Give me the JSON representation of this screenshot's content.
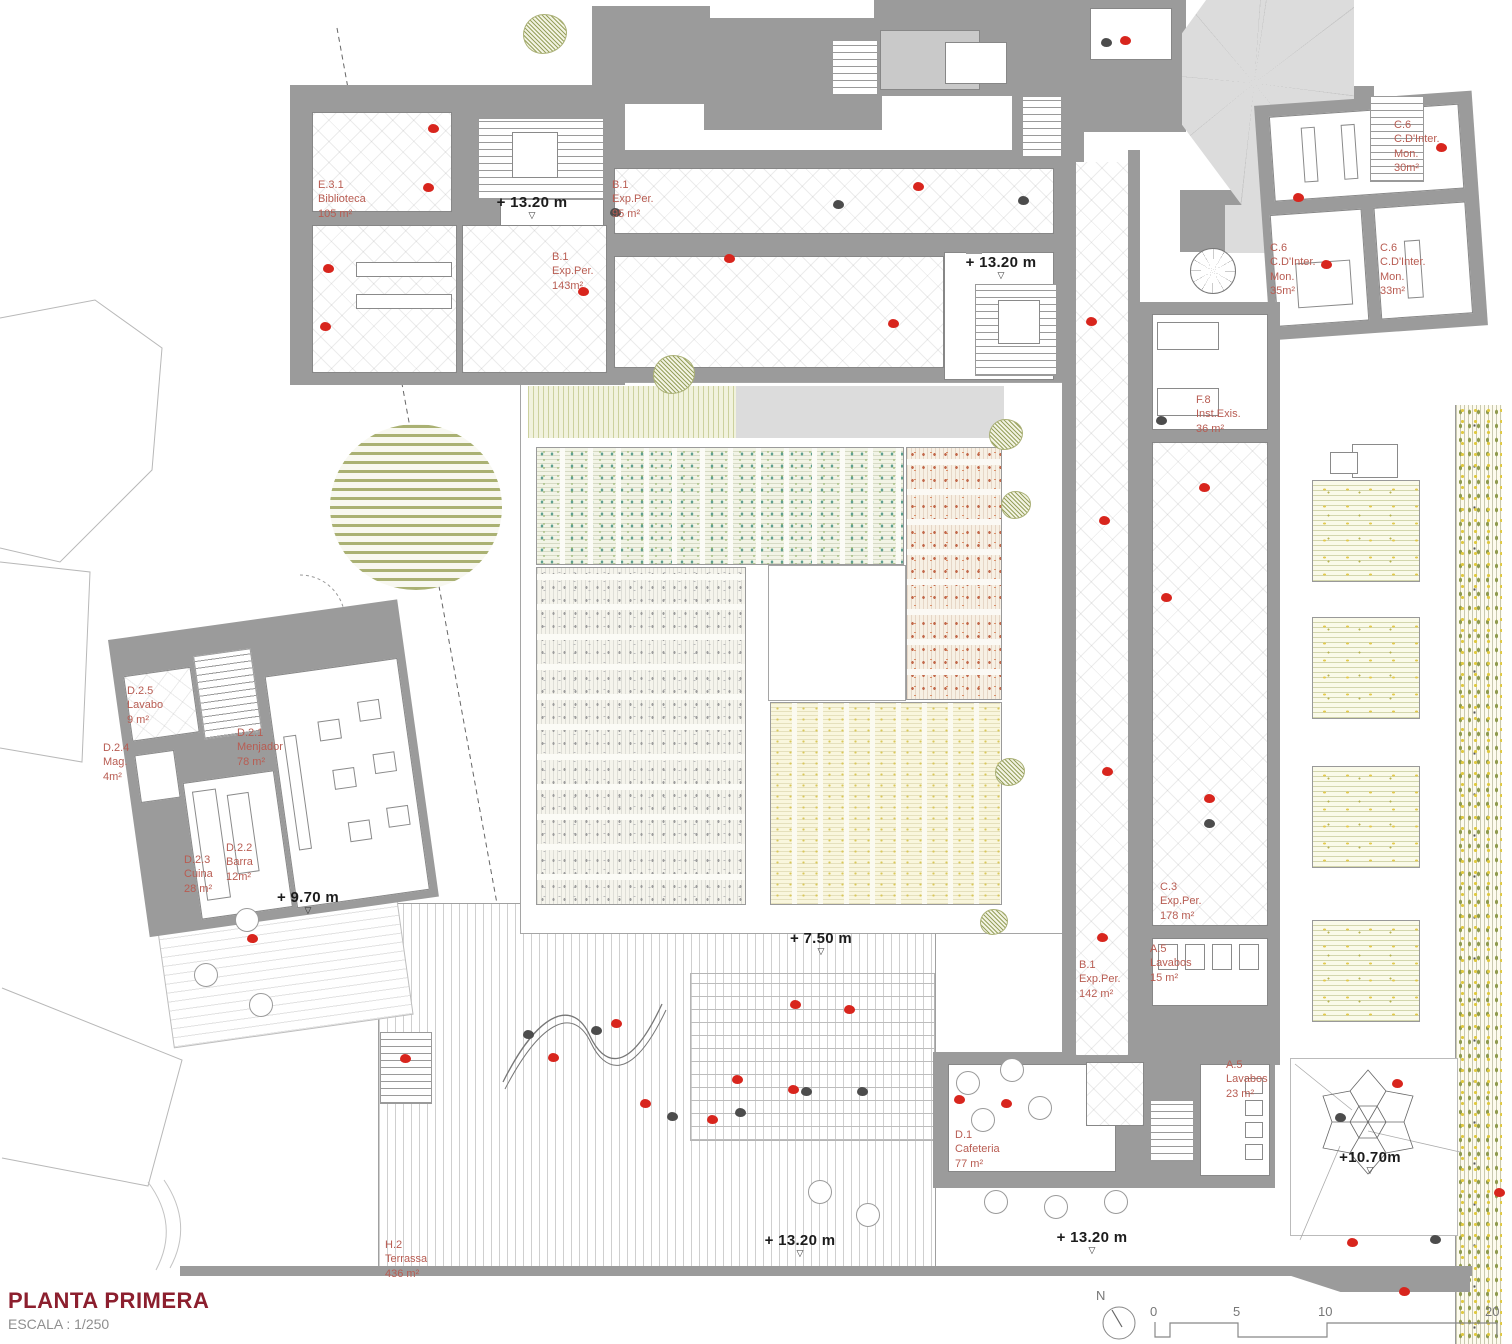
{
  "title": {
    "main": "PLANTA PRIMERA",
    "scale": "ESCALA : 1/250"
  },
  "colors": {
    "accent_red": "#d8251d",
    "label_red": "#b85c52",
    "wall_gray": "#9b9b9b",
    "title_red": "#8c1f2e"
  },
  "rooms": [
    {
      "label": "E.3.1\nBiblioteca\n105 m²"
    },
    {
      "label": "B.1\nExp.Per.\n95 m²"
    },
    {
      "label": "B.1\nExp.Per.\n143m²"
    },
    {
      "label": "C.6\nC.D'Inter.\nMon.\n30m²"
    },
    {
      "label": "C.6\nC.D'Inter.\nMon.\n35m²"
    },
    {
      "label": "C.6\nC.D'Inter.\nMon.\n33m²"
    },
    {
      "label": "F.8\nInst.Exis.\n36 m²"
    },
    {
      "label": "D.2.5\nLavabo\n9 m²"
    },
    {
      "label": "D.2.4\nMag.\n4m²"
    },
    {
      "label": "D.2.1\nMenjador\n78 m²"
    },
    {
      "label": "D.2.3\nCuina\n28 m²"
    },
    {
      "label": "D.2.2\nBarra\n12m²"
    },
    {
      "label": "C.3\nExp.Per.\n178 m²"
    },
    {
      "label": "A.5\nLavabos\n15 m²"
    },
    {
      "label": "B.1\nExp.Per.\n142 m²"
    },
    {
      "label": "A.5\nLavabos\n23 m²"
    },
    {
      "label": "D.1\nCafeteria\n77 m²"
    },
    {
      "label": "H.2\nTerrassa\n436 m²"
    }
  ],
  "levels": [
    {
      "text": "+ 13.20 m"
    },
    {
      "text": "+ 13.20 m"
    },
    {
      "text": "+ 9.70 m"
    },
    {
      "text": "+ 7.50 m"
    },
    {
      "text": "+ 13.20 m"
    },
    {
      "text": "+ 13.20 m"
    },
    {
      "text": "+10.70m"
    }
  ],
  "scalebar": {
    "north": "N",
    "ticks": [
      "0",
      "5",
      "10",
      "20"
    ]
  },
  "figures": {
    "red": [
      [
        433,
        128
      ],
      [
        428,
        187
      ],
      [
        328,
        268
      ],
      [
        325,
        326
      ],
      [
        583,
        291
      ],
      [
        729,
        258
      ],
      [
        893,
        323
      ],
      [
        918,
        186
      ],
      [
        1125,
        40
      ],
      [
        1298,
        197
      ],
      [
        1326,
        264
      ],
      [
        1441,
        147
      ],
      [
        1091,
        321
      ],
      [
        1104,
        520
      ],
      [
        1204,
        487
      ],
      [
        1166,
        597
      ],
      [
        1107,
        771
      ],
      [
        1209,
        798
      ],
      [
        1102,
        937
      ],
      [
        252,
        938
      ],
      [
        405,
        1058
      ],
      [
        553,
        1057
      ],
      [
        616,
        1023
      ],
      [
        645,
        1103
      ],
      [
        712,
        1119
      ],
      [
        795,
        1004
      ],
      [
        849,
        1009
      ],
      [
        793,
        1089
      ],
      [
        737,
        1079
      ],
      [
        959,
        1099
      ],
      [
        1006,
        1103
      ],
      [
        1397,
        1083
      ],
      [
        1352,
        1242
      ],
      [
        1404,
        1291
      ],
      [
        1499,
        1192
      ]
    ],
    "dark": [
      [
        615,
        212
      ],
      [
        838,
        204
      ],
      [
        1106,
        42
      ],
      [
        596,
        1030
      ],
      [
        528,
        1034
      ],
      [
        672,
        1116
      ],
      [
        740,
        1112
      ],
      [
        806,
        1091
      ],
      [
        862,
        1091
      ],
      [
        1209,
        823
      ],
      [
        1340,
        1117
      ],
      [
        1435,
        1239
      ],
      [
        1161,
        420
      ],
      [
        1023,
        200
      ]
    ]
  },
  "trees": [
    [
      545,
      36,
      44
    ],
    [
      674,
      376,
      42
    ],
    [
      1006,
      436,
      34
    ],
    [
      1016,
      506,
      30
    ],
    [
      1010,
      773,
      30
    ],
    [
      994,
      923,
      28
    ]
  ],
  "tables_round": [
    [
      247,
      920
    ],
    [
      206,
      975
    ],
    [
      261,
      1005
    ],
    [
      968,
      1083
    ],
    [
      1012,
      1070
    ],
    [
      1040,
      1108
    ],
    [
      983,
      1120
    ],
    [
      820,
      1192
    ],
    [
      868,
      1215
    ],
    [
      996,
      1202
    ],
    [
      1056,
      1207
    ],
    [
      1116,
      1202
    ]
  ]
}
